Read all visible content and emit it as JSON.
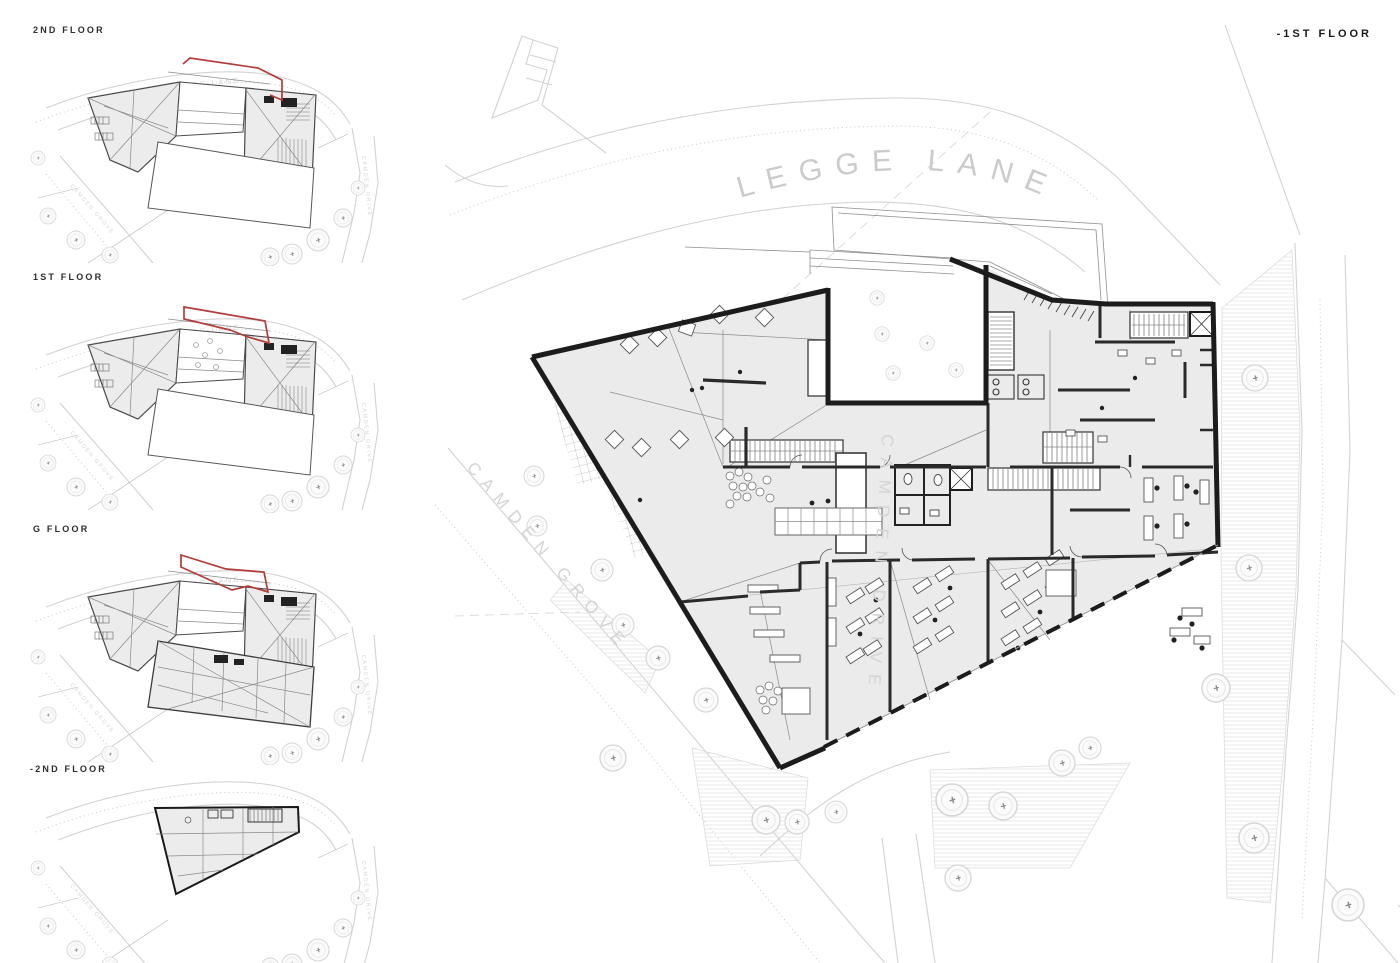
{
  "thumbnails": [
    {
      "label": "2ND FLOOR"
    },
    {
      "label": "1ST FLOOR"
    },
    {
      "label": "G FLOOR"
    },
    {
      "label": "-2ND FLOOR"
    }
  ],
  "main": {
    "title": "-1ST FLOOR"
  },
  "streets": {
    "legge_lane": "LEGGE LANE",
    "camden_grove": "CAMDEN GROVE",
    "camden_drive": "CAMDEN DRIVE"
  },
  "colors": {
    "highlight_red": "#b23c38",
    "building_fill": "#ebebeb",
    "wall_black": "#1c1c1c",
    "context_gray": "#d2d2d2",
    "street_text_gray": "#cbcbcb"
  }
}
